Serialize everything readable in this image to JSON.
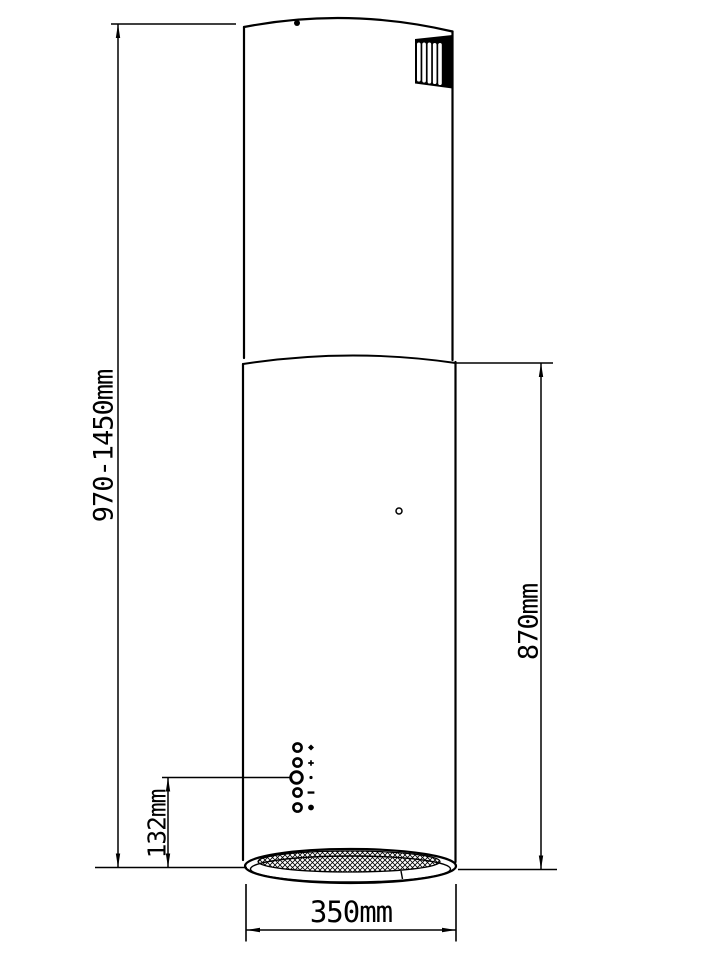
{
  "colors": {
    "ink": "#000000",
    "background": "#ffffff"
  },
  "drawing": {
    "type": "technical-dimension-drawing",
    "dimensions": {
      "total_height": "970-1450mm",
      "body_height": "870mm",
      "control_panel_offset": "132mm",
      "diameter": "350mm"
    }
  }
}
